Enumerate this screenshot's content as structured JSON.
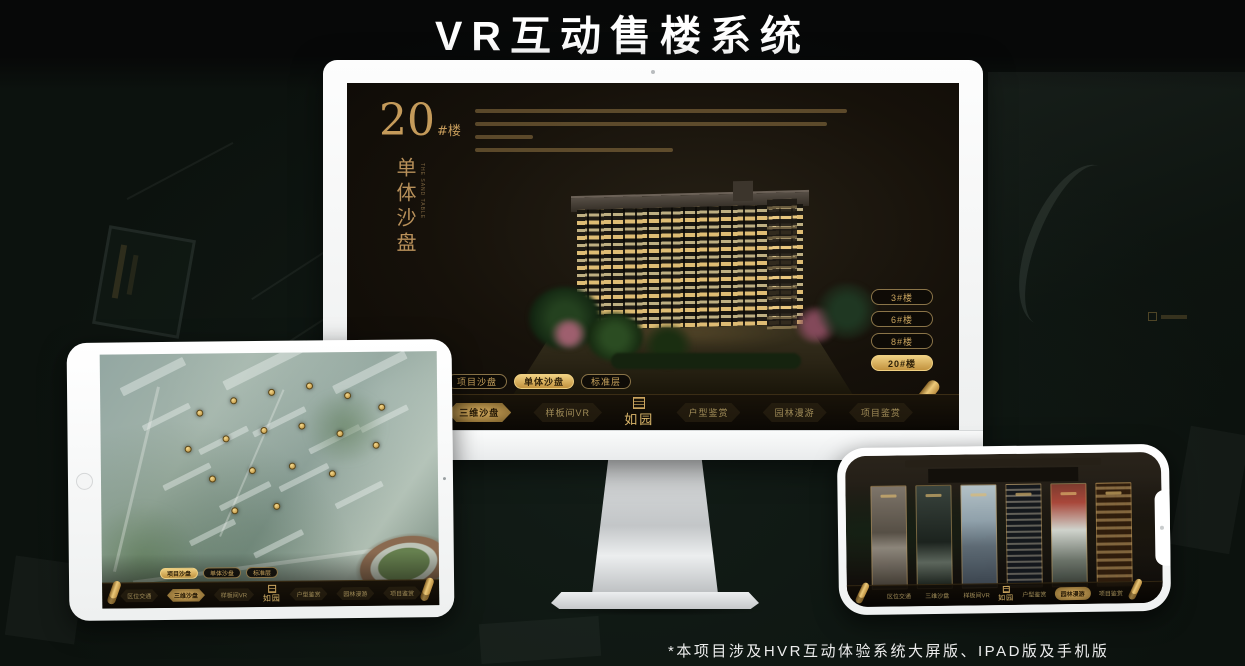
{
  "page": {
    "title": "VR互动售楼系统",
    "footnote": "*本项目涉及HVR互动体验系统大屏版、IPAD版及手机版"
  },
  "colors": {
    "gold": "#c9a45e",
    "gold_active": "#efd082",
    "screen_dark": "#16110a",
    "bezel_white": "#f5f6f6"
  },
  "monitor": {
    "building_no": "20",
    "building_no_suffix": "#楼",
    "side_title": "单体沙盘",
    "side_title_en": "THE SAND TABLE",
    "floors": [
      {
        "label": "3#楼"
      },
      {
        "label": "6#楼"
      },
      {
        "label": "8#楼"
      },
      {
        "label": "20#楼"
      }
    ],
    "tabs": [
      {
        "label": "项目沙盘"
      },
      {
        "label": "单体沙盘"
      },
      {
        "label": "标准层"
      }
    ],
    "nav": [
      {
        "label": "区位交通"
      },
      {
        "label": "三维沙盘"
      },
      {
        "label": "样板间VR"
      },
      {
        "label": "户型鉴赏"
      },
      {
        "label": "园林漫游"
      },
      {
        "label": "项目鉴赏"
      }
    ],
    "logo": "如园"
  },
  "ipad": {
    "tabs": [
      {
        "label": "项目沙盘"
      },
      {
        "label": "单体沙盘"
      },
      {
        "label": "标准层"
      }
    ],
    "nav": [
      {
        "label": "区位交通"
      },
      {
        "label": "三维沙盘"
      },
      {
        "label": "样板间VR"
      },
      {
        "label": "户型鉴赏"
      },
      {
        "label": "园林漫游"
      },
      {
        "label": "项目鉴赏"
      }
    ],
    "logo": "如园"
  },
  "phone": {
    "nav": [
      {
        "label": "区位交通"
      },
      {
        "label": "三维沙盘"
      },
      {
        "label": "样板间VR"
      },
      {
        "label": "户型鉴赏"
      },
      {
        "label": "园林漫游"
      },
      {
        "label": "项目鉴赏"
      }
    ],
    "logo": "如园"
  }
}
